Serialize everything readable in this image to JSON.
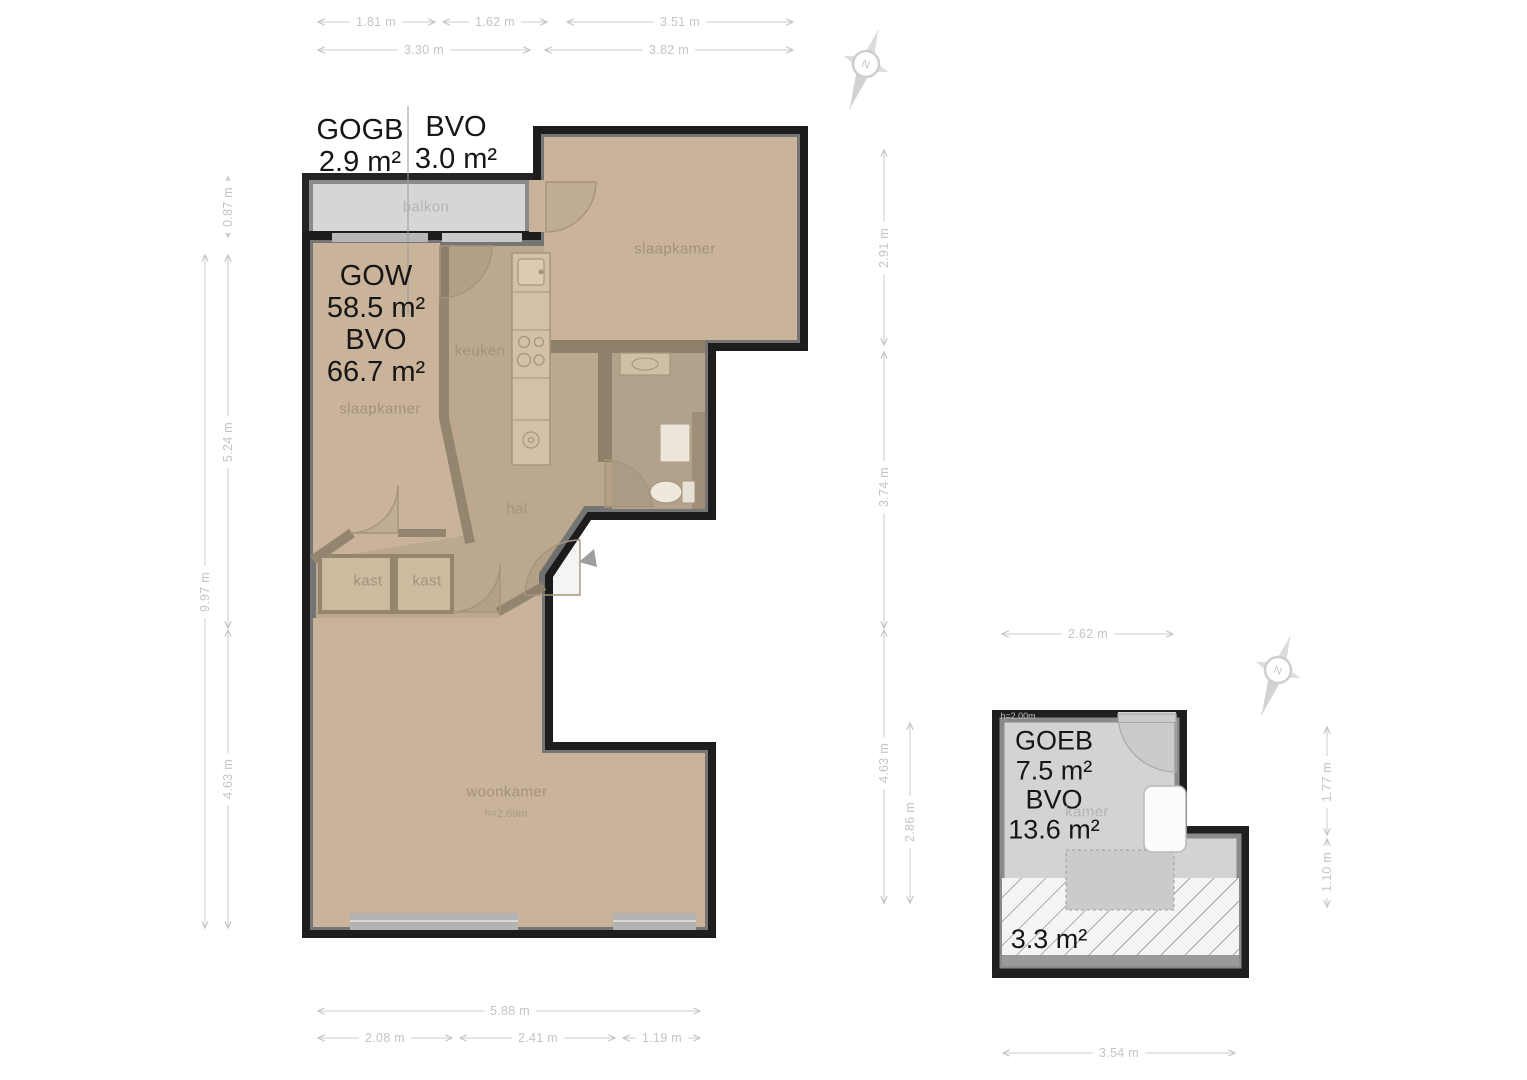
{
  "compass": {
    "label": "N"
  },
  "main_plan": {
    "summary": {
      "gogb": {
        "title": "GOGB",
        "area": "2.9 m²"
      },
      "bvo_balcony": {
        "title": "BVO",
        "area": "3.0 m²"
      },
      "gow": {
        "title": "GOW",
        "area": "58.5 m²"
      },
      "bvo": {
        "title": "BVO",
        "area": "66.7 m²"
      }
    },
    "rooms": {
      "balkon": "balkon",
      "slaapkamer_top": "slaapkamer",
      "keuken": "keuken",
      "slaapkamer_left": "slaapkamer",
      "hal": "hal",
      "kast_left": "kast",
      "kast_right": "kast",
      "woonkamer": "woonkamer",
      "woonkamer_height": "h=2.69m"
    },
    "dimensions": {
      "top_row1": [
        "1.81 m",
        "1.62 m",
        "3.51 m"
      ],
      "top_row2": [
        "3.30 m",
        "3.82 m"
      ],
      "left_inner": [
        "0.87 m",
        "5.24 m",
        "4.63 m"
      ],
      "left_outer": "9.97 m",
      "right_upper": [
        "2.91 m",
        "3.74 m"
      ],
      "right_lower": [
        "4.63 m",
        "2.86 m"
      ],
      "bottom_row1": "5.88 m",
      "bottom_row2": [
        "2.08 m",
        "2.41 m",
        "1.19 m"
      ]
    }
  },
  "storage_plan": {
    "summary": {
      "goeb": {
        "title": "GOEB",
        "area": "7.5 m²"
      },
      "bvo": {
        "title": "BVO",
        "area": "13.6 m²"
      },
      "low_height_area": "3.3 m²"
    },
    "rooms": {
      "kamer": "kamer",
      "ceiling_height": "h=2.00m"
    },
    "dimensions": {
      "top": "2.62 m",
      "right": [
        "1.77 m",
        "1.10 m"
      ],
      "bottom": "3.54 m"
    }
  }
}
